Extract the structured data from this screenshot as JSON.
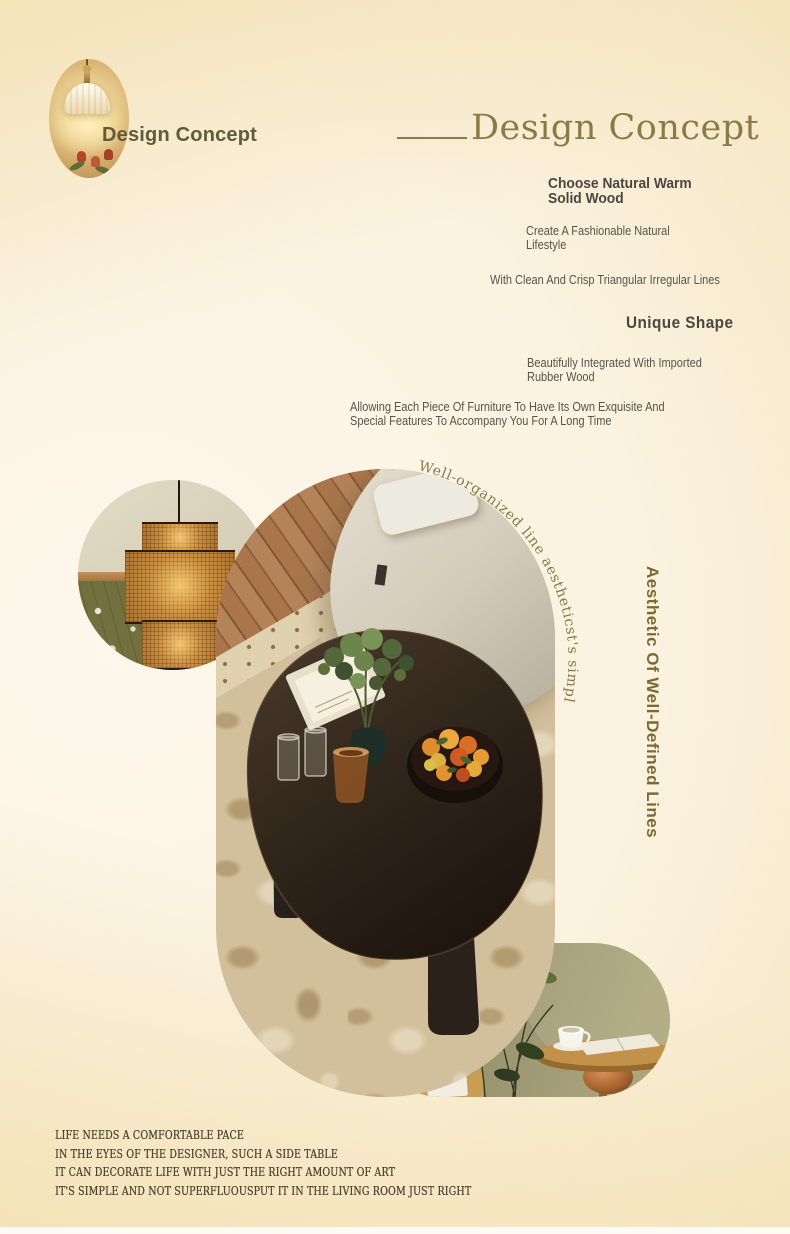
{
  "header": {
    "overlay_title": "Design Concept",
    "section_title": "Design Concept"
  },
  "concept_points": [
    "Choose Natural Warm\nSolid Wood",
    "Create A Fashionable Natural\nLifestyle",
    "With Clean And Crisp Triangular Irregular Lines",
    "Unique Shape",
    "Beautifully Integrated With Imported\nRubber Wood",
    "Allowing Each Piece Of Furniture To Have Its Own Exquisite And\nSpecial Features To Accompany You For A Long Time"
  ],
  "captions": {
    "curved": "Well-organized line aestheticst's simple",
    "vertical": "Aesthetic Of Well-Defined Lines"
  },
  "footer": {
    "lines": [
      "LIFE NEEDS A COMFORTABLE PACE",
      "IN THE EYES OF THE DESIGNER, SUCH A SIDE TABLE",
      "IT CAN DECORATE LIFE WITH JUST THE RIGHT AMOUNT OF ART",
      "IT'S SIMPLE AND NOT SUPERFLUOUSPUT IT IN THE LIVING ROOM JUST RIGHT"
    ]
  },
  "photos": {
    "hero": "brass pendant wall lamp with tulips",
    "circle": "rattan woven pendant lamp",
    "main": "black triangular coffee table on vintage rug beside cream sofa",
    "side": "round wooden side table with coffee cup and plant"
  },
  "colors": {
    "accent_serif": "#8b7a45",
    "overlay_olive": "#5f5c39",
    "heading_text": "#494740",
    "body_text": "#56544b",
    "vertical_caption": "#7c6a31",
    "footer_text": "#4e4633",
    "background_cream": "#fbf2e0",
    "background_warm": "#f2e2b8"
  }
}
